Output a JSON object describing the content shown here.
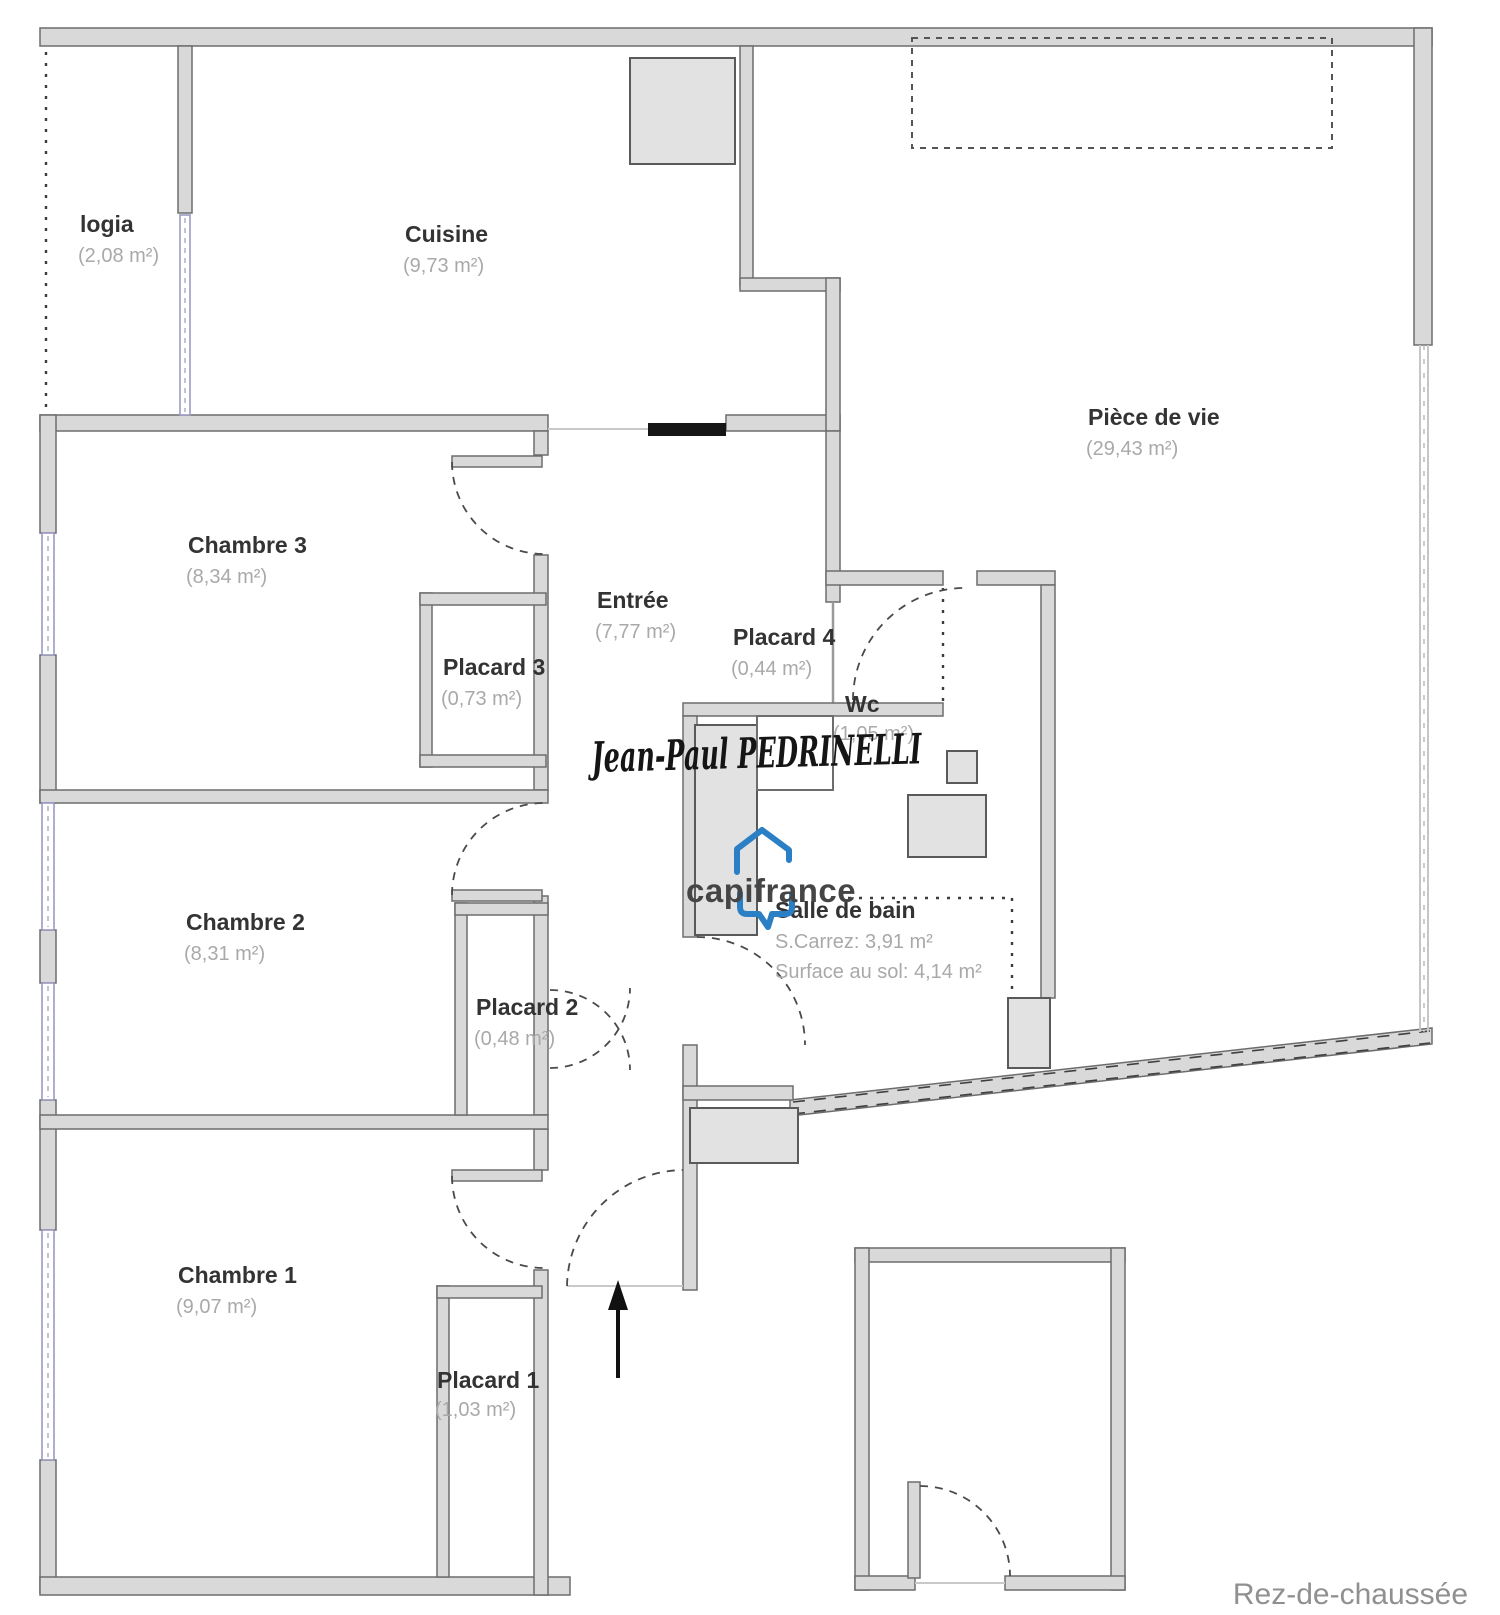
{
  "floor": {
    "caption": "Rez-de-chaussée"
  },
  "branding": {
    "watermark": "Jean-Paul PEDRINELLI",
    "logo_text": "capifrance",
    "logo_color": "#2b7fc4"
  },
  "colors": {
    "wall_fill": "#d9d9d9",
    "wall_stroke": "#6d6d6d",
    "window_tint": "#9a9ac2",
    "room_name": "#333333",
    "room_area": "#a9a9a9",
    "caption_gray": "#909090"
  },
  "rooms": {
    "logia": {
      "name": "logia",
      "area": "(2,08 m²)"
    },
    "cuisine": {
      "name": "Cuisine",
      "area": "(9,73 m²)"
    },
    "piece_de_vie": {
      "name": "Pièce de vie",
      "area": "(29,43 m²)"
    },
    "chambre3": {
      "name": "Chambre 3",
      "area": "(8,34 m²)"
    },
    "chambre2": {
      "name": "Chambre 2",
      "area": "(8,31 m²)"
    },
    "chambre1": {
      "name": "Chambre 1",
      "area": "(9,07 m²)"
    },
    "placard1": {
      "name": "Placard 1",
      "area": "(1,03 m²)"
    },
    "placard2": {
      "name": "Placard 2",
      "area": "(0,48 m²)"
    },
    "placard3": {
      "name": "Placard 3",
      "area": "(0,73 m²)"
    },
    "placard4": {
      "name": "Placard 4",
      "area": "(0,44 m²)"
    },
    "entree": {
      "name": "Entrée",
      "area": "(7,77 m²)"
    },
    "wc": {
      "name": "Wc",
      "area": "(1,05 m²)"
    },
    "salle_de_bain": {
      "name": "Salle de bain",
      "carrez": "S.Carrez: 3,91 m²",
      "surface": "Surface au sol: 4,14 m²"
    }
  }
}
